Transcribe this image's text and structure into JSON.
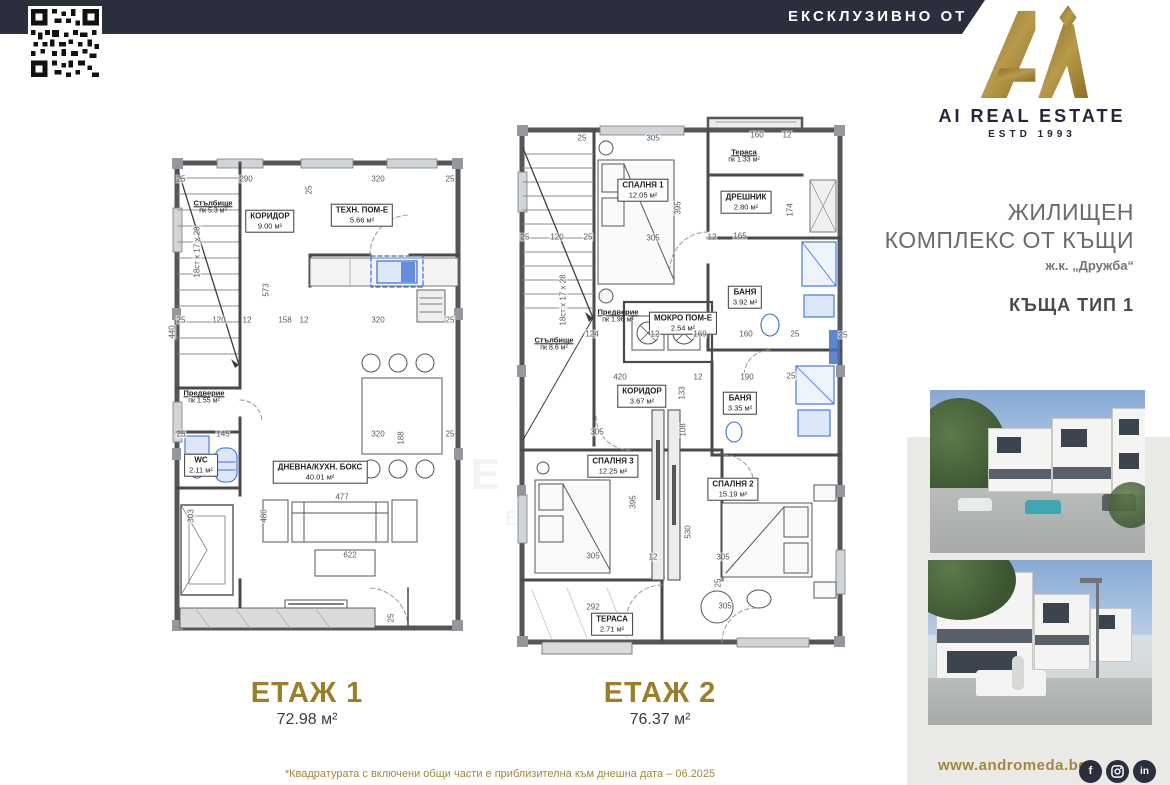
{
  "banner": {
    "text": "ЕКСКЛУЗИВНО ОТ"
  },
  "logo": {
    "name": "AI REAL ESTATE",
    "estd": "ESTD 1993",
    "monogram": "Ai"
  },
  "project": {
    "line1": "ЖИЛИЩЕН",
    "line2": "КОМПЛЕКС ОТ КЪЩИ",
    "location": "ж.к. „Дружба“",
    "house_type": "КЪЩА ТИП 1"
  },
  "watermark": {
    "line1": "A",
    "line2": "REAL ESTATE",
    "line3": "ESTD 1993"
  },
  "floors": [
    {
      "title": "ЕТАЖ 1",
      "area": "72.98 м²",
      "rooms": [
        {
          "label": "Стълбище",
          "area": "пк 5.3 м²"
        },
        {
          "label": "КОРИДОР",
          "area": "9.00 м²"
        },
        {
          "label": "ТЕХН. ПОМ-Е",
          "area": "5.66 м²"
        },
        {
          "label": "Предверие",
          "area": "пк 1.55 м²"
        },
        {
          "label": "WC",
          "area": "2.11 м²"
        },
        {
          "label": "ДНЕВНА/КУХН. БОКС",
          "area": "40.01 м²"
        }
      ],
      "dims": [
        "25",
        "290",
        "25",
        "320",
        "25",
        "573",
        "18ст х 17 х 28",
        "440",
        "25",
        "120",
        "12",
        "158",
        "12",
        "320",
        "25",
        "25",
        "145",
        "320",
        "188",
        "25",
        "477",
        "480",
        "303",
        "622",
        "25"
      ]
    },
    {
      "title": "ЕТАЖ 2",
      "area": "76.37 м²",
      "rooms": [
        {
          "label": "СПАЛНЯ 1",
          "area": "12.05 м²"
        },
        {
          "label": "Тераса",
          "area": "пк 1.33 м²"
        },
        {
          "label": "ДРЕШНИК",
          "area": "2.80 м²"
        },
        {
          "label": "БАНЯ",
          "area": "3.92 м²"
        },
        {
          "label": "МОКРО ПОМ-Е",
          "area": "2.54 м²"
        },
        {
          "label": "Предверие",
          "area": "пк 1.96 м²"
        },
        {
          "label": "Стълбище",
          "area": "пк 8.6 м²"
        },
        {
          "label": "КОРИДОР",
          "area": "3.67 м²"
        },
        {
          "label": "БАНЯ",
          "area": "3.35 м²"
        },
        {
          "label": "СПАЛНЯ 3",
          "area": "12.25 м²"
        },
        {
          "label": "СПАЛНЯ 2",
          "area": "15.19 м²"
        },
        {
          "label": "ТЕРАСА",
          "area": "2.71 м²"
        }
      ],
      "dims": [
        "25",
        "305",
        "160",
        "12",
        "395",
        "25",
        "120",
        "25",
        "305",
        "12",
        "165",
        "174",
        "124",
        "12",
        "169",
        "160",
        "25",
        "420",
        "12",
        "190",
        "25",
        "305",
        "133",
        "108",
        "395",
        "530",
        "12",
        "305",
        "305",
        "292",
        "305",
        "25",
        "25",
        "18ст х 17 х 28"
      ]
    }
  ],
  "footnote": "*Квадратурата с включени общи части е приблизителна към днешна дата – 06.2025",
  "footer": {
    "website": "www.andromeda.bg",
    "social": [
      "facebook",
      "instagram",
      "linkedin"
    ],
    "facebook_glyph": "f",
    "linkedin_glyph": "in"
  },
  "colors": {
    "navy": "#2b2e3d",
    "gold": "#a5873b",
    "floor_title_gold": "#9c7e2a",
    "panel_gray": "#e9eae6",
    "plan_blue": "#3a6fd8",
    "text_gray": "#6b6b6b"
  }
}
